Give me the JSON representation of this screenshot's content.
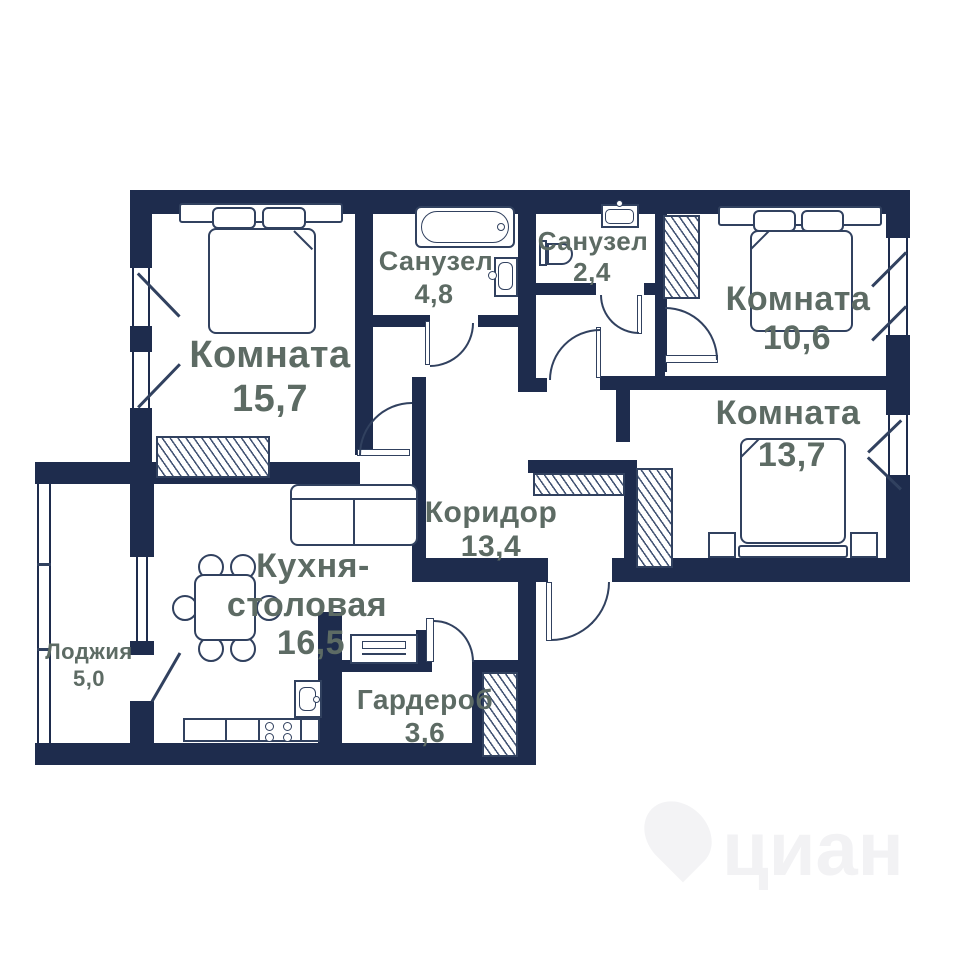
{
  "floorplan": {
    "rooms": {
      "room_15_7": {
        "label": "Комната",
        "area": "15,7"
      },
      "bathroom_4_8": {
        "label": "Санузел",
        "area": "4,8"
      },
      "bathroom_2_4": {
        "label": "Санузел",
        "area": "2,4"
      },
      "room_10_6": {
        "label": "Комната",
        "area": "10,6"
      },
      "room_13_7": {
        "label": "Комната",
        "area": "13,7"
      },
      "corridor": {
        "label": "Коридор",
        "area": "13,4"
      },
      "kitchen": {
        "label_line1": "Кухня-",
        "label_line2": "столовая",
        "area": "16,5"
      },
      "wardrobe": {
        "label": "Гардероб",
        "area": "3,6"
      },
      "loggia": {
        "label": "Лоджия",
        "area": "5,0"
      }
    },
    "colors": {
      "wall": "#1e2c4d",
      "label_text": "#5d6b64",
      "furniture_line": "#31415f"
    },
    "watermark": "циан"
  }
}
